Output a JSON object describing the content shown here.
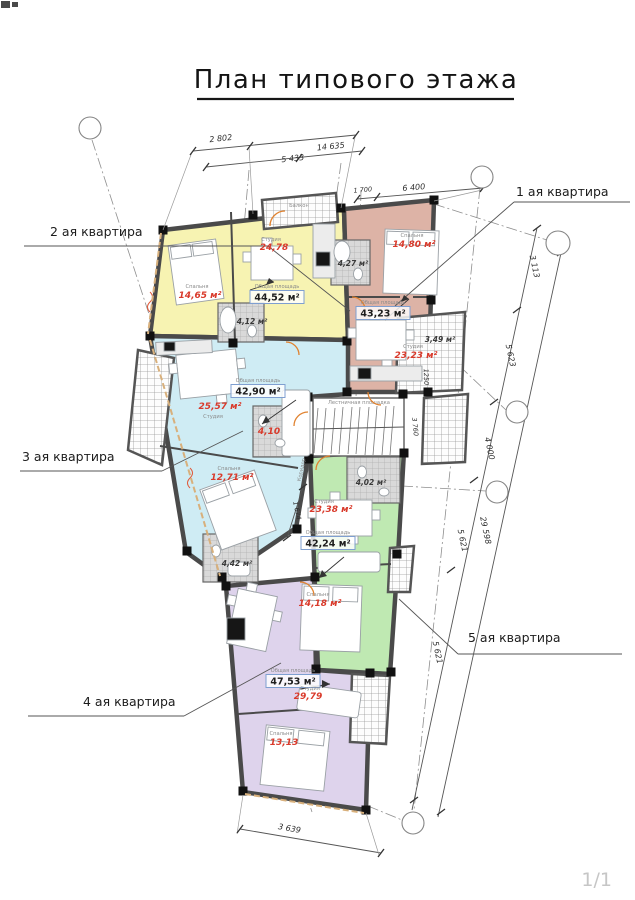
{
  "title": "План типового этажа",
  "page_indicator": "1/1",
  "callouts": {
    "apt1": "1 ая квартира",
    "apt2": "2 ая квартира",
    "apt3": "3 ая квартира",
    "apt4": "4 ая квартира",
    "apt5": "5 ая квартира"
  },
  "dimensions": {
    "top": [
      "2 802",
      "5 433",
      "14 635",
      "1 700",
      "6 400"
    ],
    "right": [
      "3 113",
      "5 623",
      "4 000",
      "5 621",
      "29 598",
      "5 621"
    ],
    "bottom": [
      "3 639"
    ],
    "internal": [
      "1 674",
      "1250",
      "3 760"
    ]
  },
  "labels": {
    "balcony": "Балкон",
    "stair_landing": "Лестничная площадка",
    "corridor": "Коридор",
    "caption_bedroom": "Спальня",
    "caption_studio": "Студия",
    "caption_total": "Общая площадь"
  },
  "apartments": {
    "apt1": {
      "bedroom": "14,80 м²",
      "total": "43,23 м²",
      "studio": "23,23 м²",
      "bath": "4,27 м²",
      "balcony": "3,49 м²"
    },
    "apt2": {
      "bedroom": "14,65 м²",
      "studio": "24,78",
      "total": "44,52 м²",
      "bath": "4,12 м²"
    },
    "apt3": {
      "total": "42,90 м²",
      "studio": "25,57 м²",
      "bath": "4,10",
      "bedroom": "12,71 м²",
      "bath2": "4,42 м²"
    },
    "apt4": {
      "total": "47,53 м²",
      "studio": "29,79",
      "bedroom": "13,13"
    },
    "apt5": {
      "bath": "4,02 м²",
      "studio": "23,38 м²",
      "total": "42,24 м²",
      "bedroom": "14,18 м²"
    }
  },
  "colors": {
    "apt1_fill": "#ddb3a6",
    "apt2_fill": "#f7f3b2",
    "apt3_fill": "#cfecf4",
    "apt4_fill": "#ded3ec",
    "apt5_fill": "#bfe9b2",
    "area_accent": "#d93a2b",
    "wall": "#4a4a4a",
    "total_box_border": "#7f9fd0"
  }
}
